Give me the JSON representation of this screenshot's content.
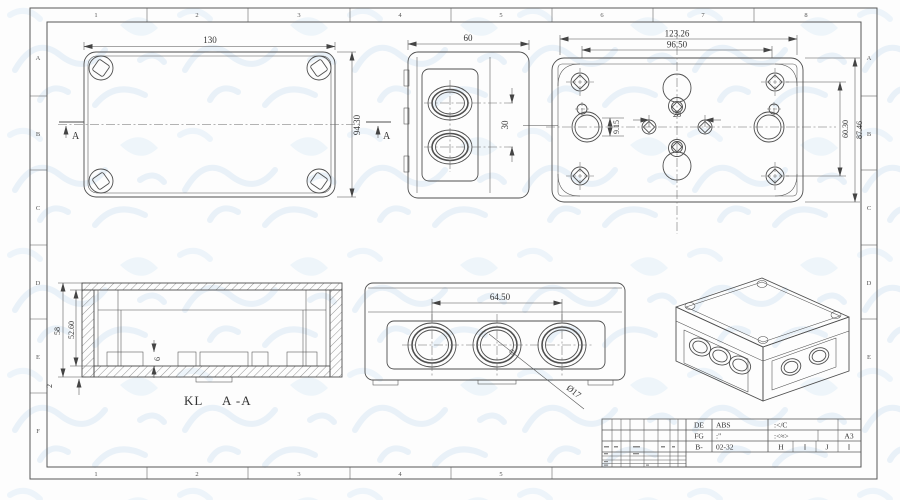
{
  "sheet": {
    "zones_horizontal": [
      "1",
      "2",
      "3",
      "4",
      "5",
      "6",
      "7",
      "8"
    ],
    "zones_vertical": [
      "A",
      "B",
      "C",
      "D",
      "E",
      "F"
    ],
    "line_color": "#4f4f4f",
    "watermark_color": "#d8e7f4"
  },
  "views": {
    "top": {
      "dim_width": "130",
      "dim_height": "94.30",
      "section_marker": "A"
    },
    "side": {
      "dim_width": "60",
      "dim_pitch": "30"
    },
    "back": {
      "dim_overall": "123.26",
      "dim_screws": "96.50",
      "dim_offset": "9.15",
      "dim_pitch": "28",
      "dim_screw_height": "60.30",
      "dim_overall_height": "87.46"
    },
    "section": {
      "label": "KL",
      "section_name": "A -A",
      "dim_height": "58",
      "dim_inner_height": "52.60",
      "dim_rib": "6",
      "dim_wall": "2"
    },
    "front": {
      "dim_pitch": "64.50",
      "dim_hole": "Ø17"
    }
  },
  "title_block": {
    "r1c1": "DE",
    "r1c2": "ABS",
    "r1c3": ":</C",
    "r2c1": "FG",
    "r2c2": ":\"",
    "r2c3": ":<≈>",
    "r2c4": "A3",
    "r3c1": "B-",
    "r3c2": "02-32",
    "r3c3": "H",
    "r3c4": "I",
    "r3c5": "J",
    "r3c6": "I"
  }
}
